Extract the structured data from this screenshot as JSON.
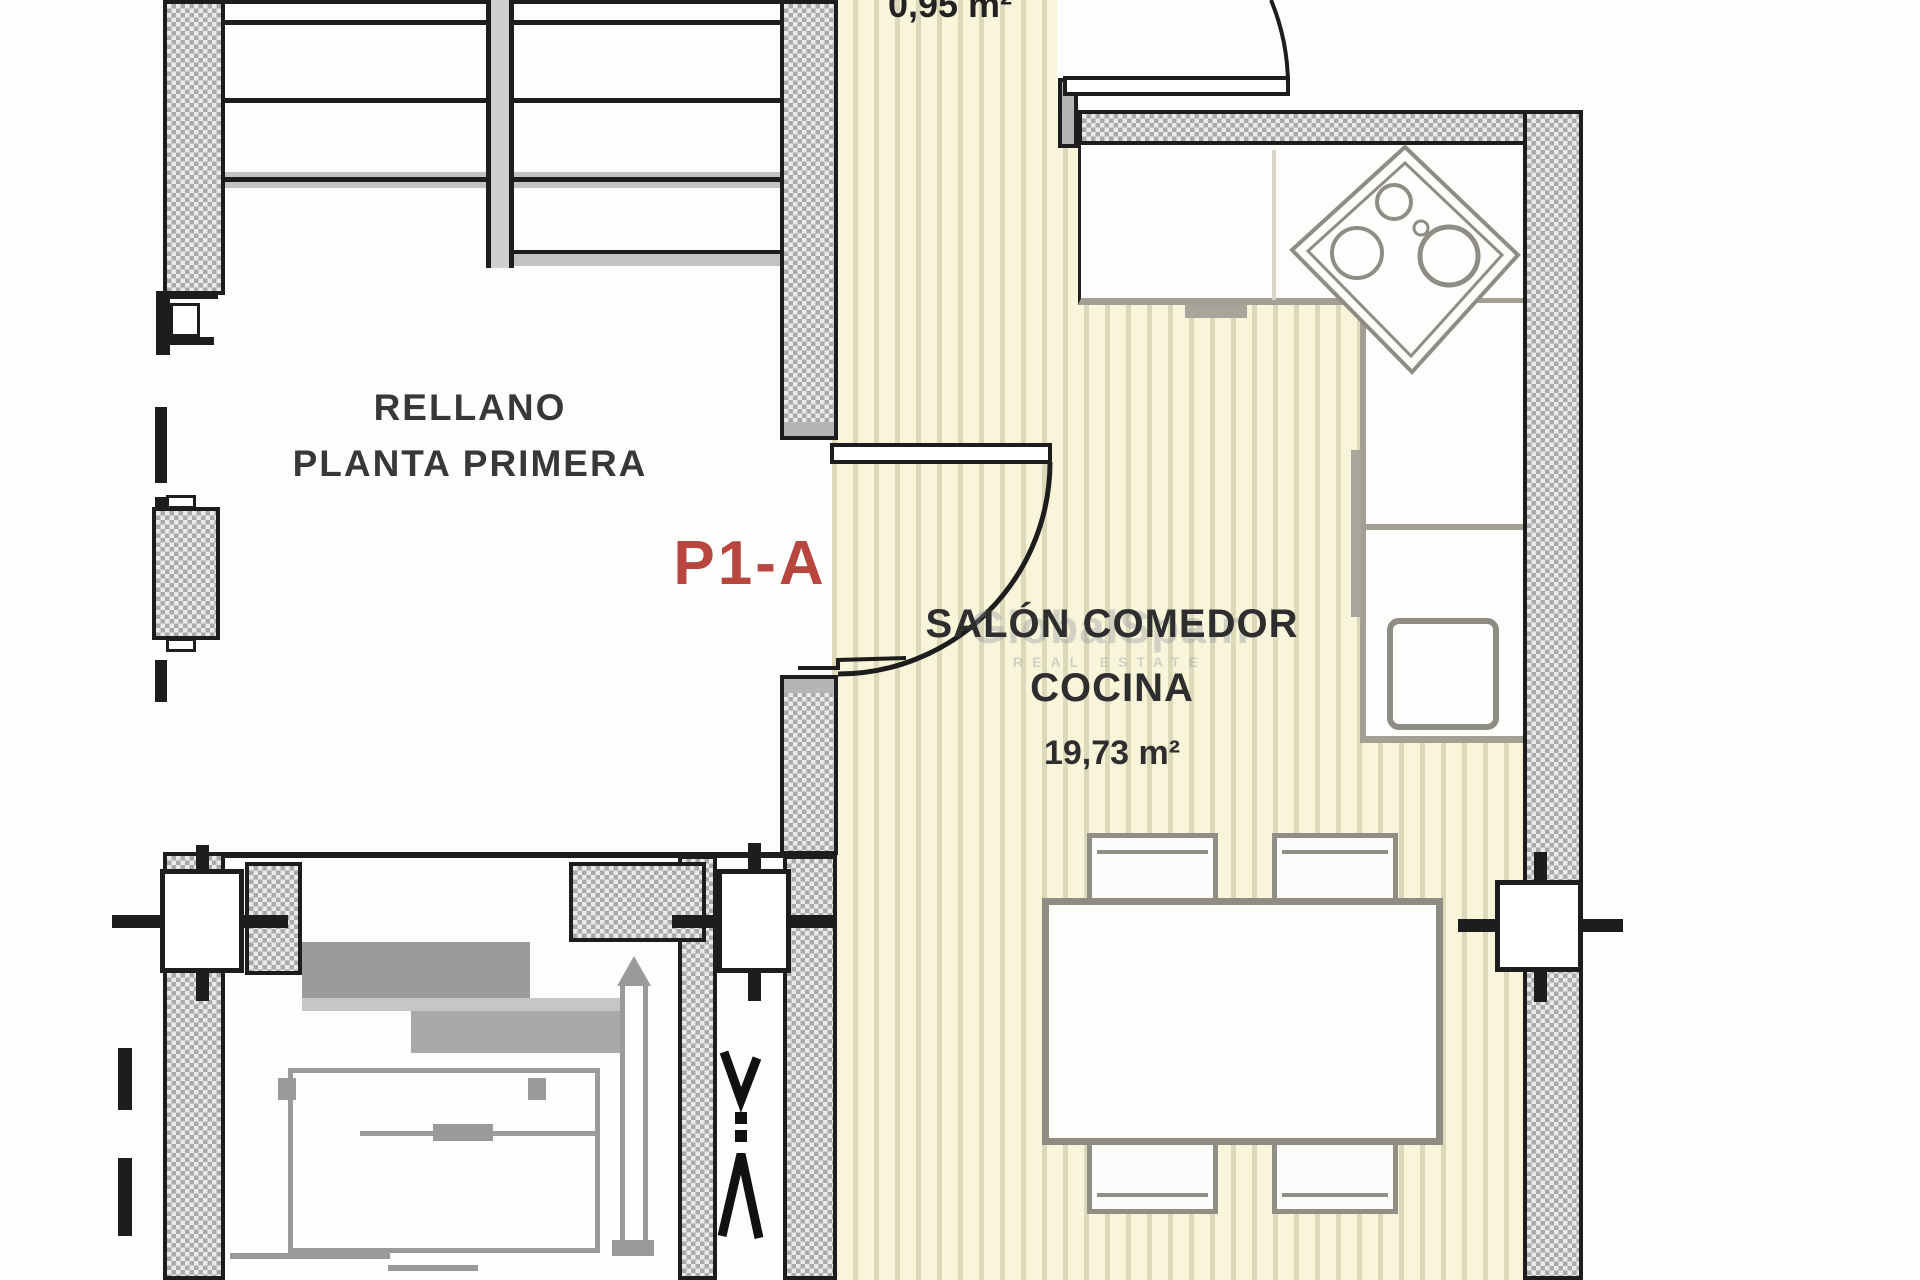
{
  "document": {
    "type": "architectural floor plan"
  },
  "unit": {
    "label": "P1-A"
  },
  "rooms": {
    "rellano": {
      "line1": "RELLANO",
      "line2": "PLANTA PRIMERA"
    },
    "salon": {
      "line1": "SALÓN COMEDOR",
      "line2": "COCINA",
      "area": "19,73 m²"
    },
    "patinillo": {
      "area": "0,95 m²"
    }
  },
  "watermark": {
    "line1": "GlobalSpain",
    "line2": "REAL ESTATE"
  },
  "colors": {
    "floor": "#f8f5da",
    "floor_stripe": "#dcd8ba",
    "wall_hatch_dark": "#a9a9a9",
    "wall_hatch_light": "#e9e9e9",
    "outline_black": "#1d1d1d",
    "furniture_gray": "#8f8d83",
    "elevator_gray": "#9a9a9a",
    "unit_label_red": "#b8453e",
    "text": "#2e2e2e"
  }
}
